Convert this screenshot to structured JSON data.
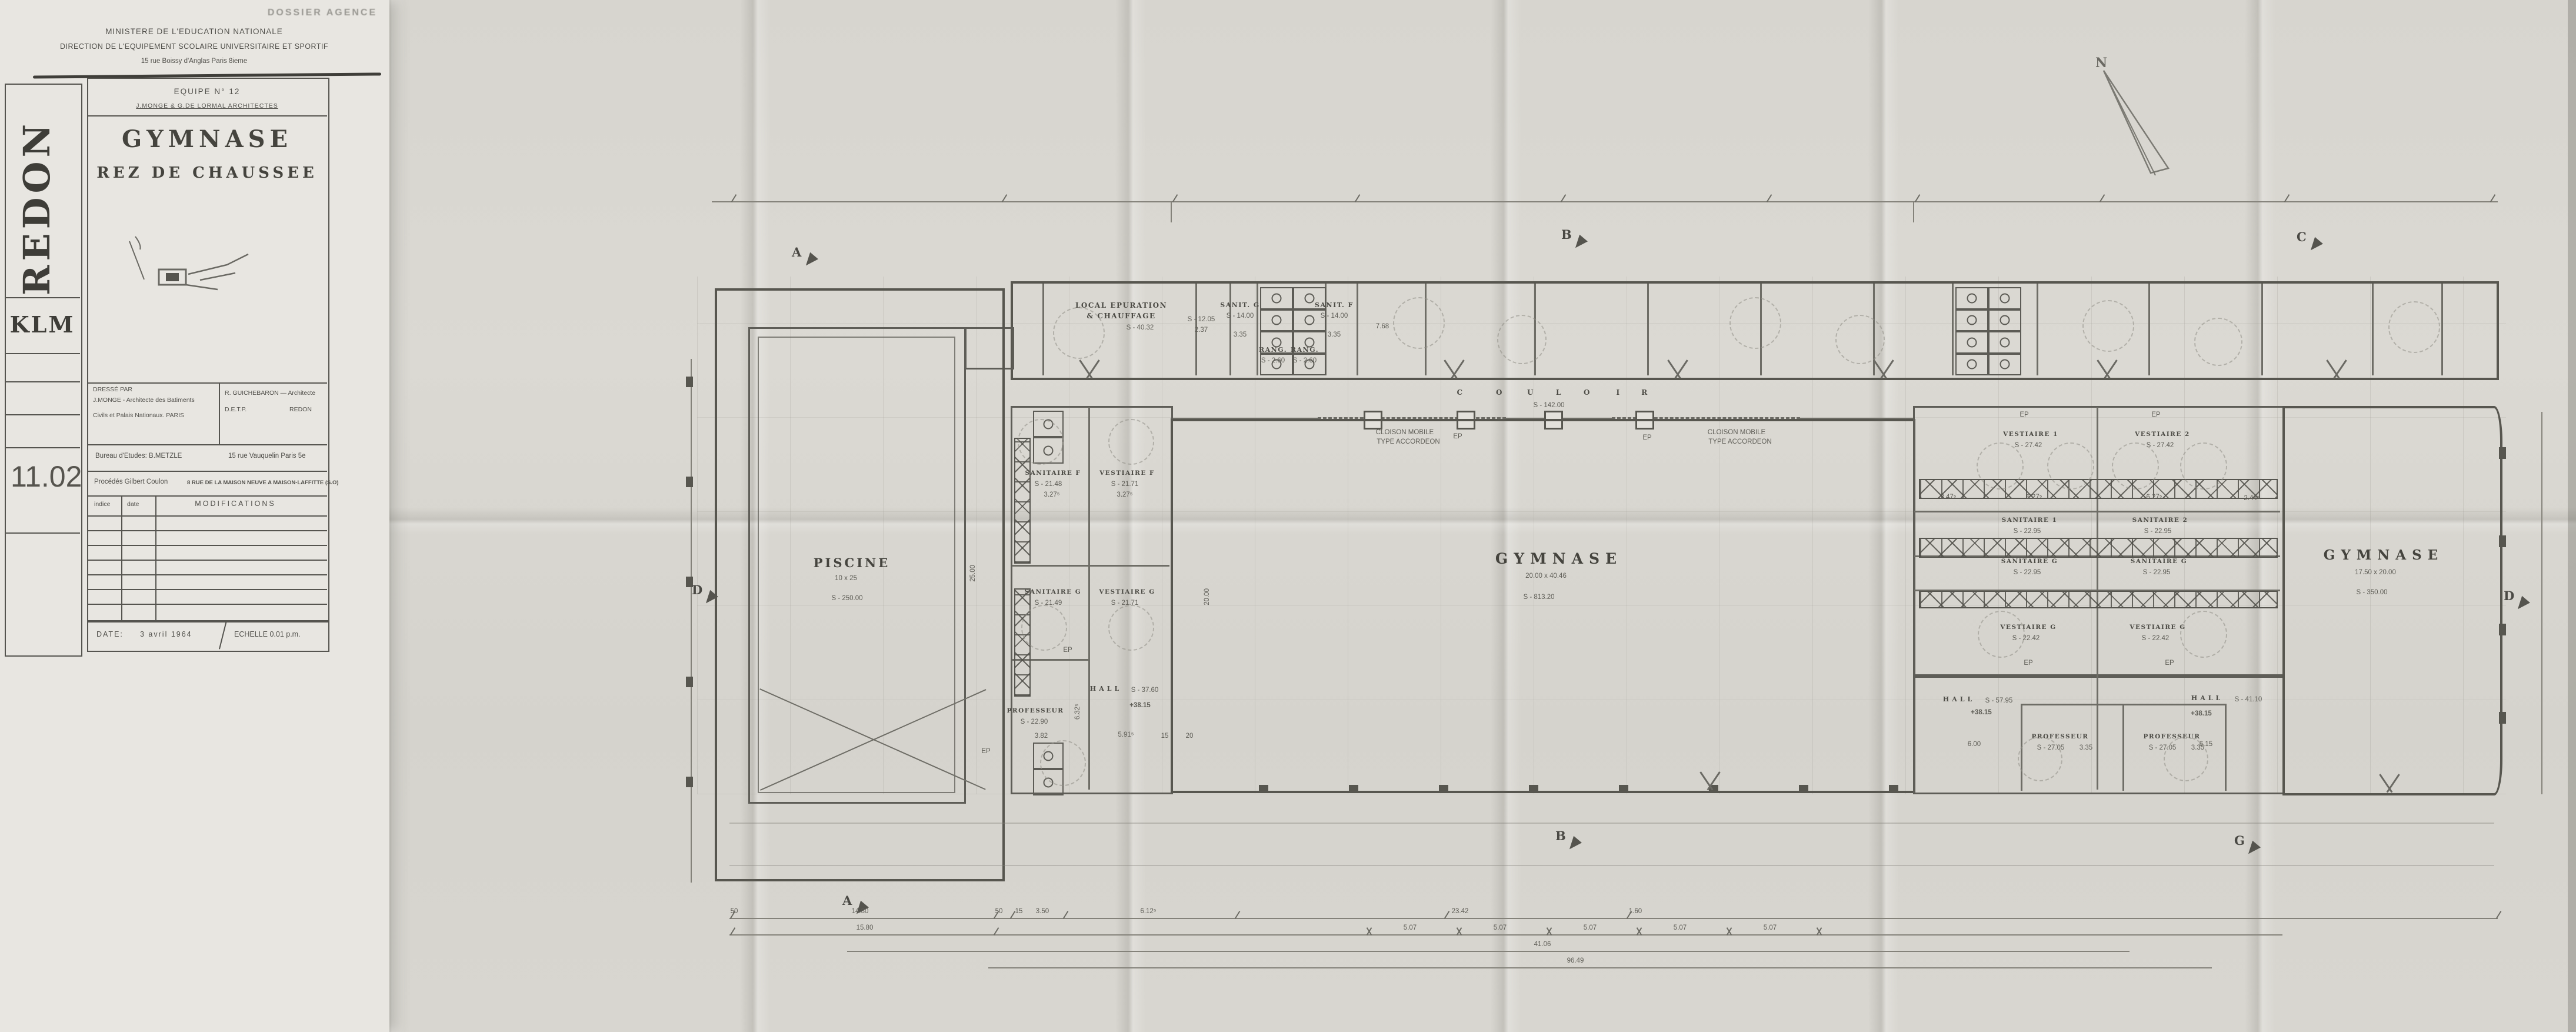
{
  "header": {
    "stamp": "DOSSIER AGENCE",
    "line1": "MINISTERE DE L'EDUCATION NATIONALE",
    "line2": "DIRECTION DE L'EQUIPEMENT SCOLAIRE UNIVERSITAIRE ET SPORTIF",
    "line3": "15 rue Boissy d'Anglas Paris 8ieme"
  },
  "title_block": {
    "equipe": "EQUIPE N° 12",
    "architectes": "J.MONGE & G.DE LORMAL ARCHITECTES",
    "title": "GYMNASE",
    "subtitle": "REZ DE CHAUSSEE",
    "dresse_par": "DRESSÉ PAR",
    "arch1_l1": "J.MONGE - Architecte des Batiments",
    "arch1_l2": "Civils et Palais Nationaux. PARIS",
    "arch2_l1": "R. GUICHEBARON — Architecte",
    "arch2_l2": "D.E.T.P.",
    "arch2_l3": "REDON",
    "bureau": "Bureau d'Etudes: B.METZLE",
    "bureau_addr": "15 rue Vauquelin  Paris 5e",
    "procedes": "Procédés Gilbert Coulon",
    "procedes_addr": "8 RUE DE LA MAISON NEUVE A MAISON-LAFFITTE (S.O)",
    "col_indice": "indice",
    "col_date": "date",
    "col_modifications": "MODIFICATIONS",
    "date_label": "DATE:",
    "date_value": "3 avril 1964",
    "echelle": "ECHELLE 0.01 p.m."
  },
  "side": {
    "city": "REDON",
    "code": "KLM",
    "number": "11.02"
  },
  "plan": {
    "north_letter": "N",
    "rooms": {
      "local_epuration": {
        "name": "LOCAL EPURATION",
        "name2": "& CHAUFFAGE",
        "area": "S - 40.32"
      },
      "store_top": {
        "area": "S - 12.05",
        "dim": "2.37"
      },
      "sanit_g_top": {
        "name": "SANIT. G",
        "area": "S - 14.00",
        "dim": "3.35"
      },
      "rang": {
        "name": "RANG.",
        "area": "S - 2.60"
      },
      "sanit_f_top": {
        "name": "SANIT. F",
        "area": "S - 14.00",
        "dim": "3.35"
      },
      "piscine": {
        "name": "PISCINE",
        "dim": "10 x 25",
        "area": "S - 250.00"
      },
      "sanitaire_f": {
        "name": "SANITAIRE F",
        "area": "S - 21.48",
        "dim": "3.27⁵"
      },
      "vestiaire_f": {
        "name": "VESTIAIRE F",
        "area": "S - 21.71",
        "dim": "3.27⁵"
      },
      "sanitaire_g": {
        "name": "SANITAIRE G",
        "area": "S - 21.49"
      },
      "vestiaire_g": {
        "name": "VESTIAIRE G",
        "area": "S - 21.71"
      },
      "hall_piscine": {
        "name": "HALL",
        "area": "S - 37.60"
      },
      "prof_piscine": {
        "name": "PROFESSEUR",
        "area": "S - 22.90"
      },
      "gymnase": {
        "name": "GYMNASE",
        "dim": "20.00 x 40.46",
        "area": "S - 813.20"
      },
      "vestiaire1": {
        "name": "VESTIAIRE 1",
        "area": "S - 27.42"
      },
      "vestiaire2": {
        "name": "VESTIAIRE 2",
        "area": "S - 27.42"
      },
      "sanitaire1": {
        "name": "SANITAIRE 1",
        "area": "S - 22.95"
      },
      "sanitaire2": {
        "name": "SANITAIRE 2",
        "area": "S - 22.95"
      },
      "sanitaire_g2": {
        "name": "SANITAIRE G",
        "area": "S - 22.95"
      },
      "vestiaire_g2": {
        "name": "VESTIAIRE G",
        "area": "S - 22.42"
      },
      "hall1": {
        "name": "HALL",
        "area": "S - 57.95"
      },
      "hall2": {
        "name": "HALL",
        "area": "S - 41.10"
      },
      "prof": {
        "name": "PROFESSEUR",
        "area": "S - 27.05",
        "dim": "3.35"
      },
      "gymnase2": {
        "name": "GYMNASE",
        "dim": "17.50 x 20.00",
        "area": "S - 350.00"
      }
    },
    "couloir": {
      "letters": [
        "C",
        "O",
        "U",
        "L",
        "O",
        "I",
        "R"
      ],
      "area": "S - 142.00"
    },
    "cloison_l1": "CLOISON MOBILE",
    "cloison_l2": "TYPE ACCORDEON",
    "level": "+38.15",
    "ep": "EP",
    "sections": {
      "a": "A",
      "b": "B",
      "c": "C",
      "d": "D",
      "g": "G"
    },
    "dims": {
      "a": "50",
      "b": "14.80",
      "c": "15.80",
      "d": "15",
      "e": "3.50",
      "f": "6.12⁵",
      "g": "23.42",
      "h": "1.60",
      "bay": "5.07",
      "total1": "41.06",
      "total2": "96.49",
      "pool_l": "25.00",
      "gym_h": "20.00",
      "r1": "2.47⁵",
      "r2": "6.27⁵",
      "r3": "2.44⁵",
      "s1": "3.82",
      "s2": "5.91⁵",
      "s3": "6.32⁵",
      "s4": "6.00",
      "s5": "6.15",
      "s6": "7.68",
      "s7": "20",
      "s8": "15"
    }
  }
}
